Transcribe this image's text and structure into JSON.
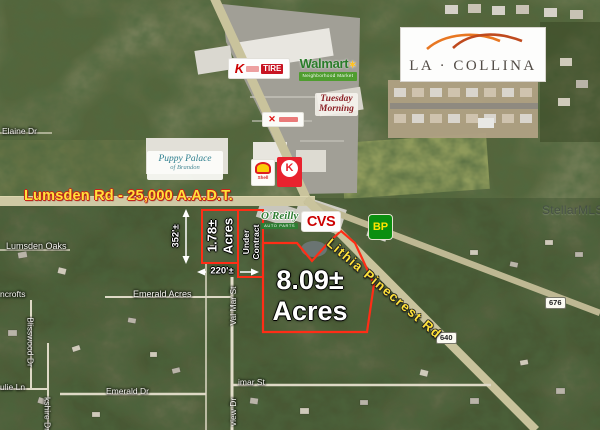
{
  "listing_map": {
    "watermark": "StellarMLS",
    "brand": {
      "la_collina": "LA · COLLINA"
    },
    "roads": {
      "lumsden_label": "Lumsden Rd - 25,000 A.A.D.T.",
      "lithia_label": "Lithia Pinecrest Rd",
      "shield_676": "676",
      "shield_640": "640"
    },
    "streets": {
      "elaine": "Elaine Dr",
      "lumsden_oaks": "Lumsden Oaks",
      "ncrofts": "ncrofts",
      "blisswood": "Blisswood Dr",
      "julie": "ulie Ln",
      "berkshire": "kshire Dr",
      "emerald_acres": "Emerald Acres",
      "emerald_dr": "Emerald Dr",
      "valmar": "Val Mar St",
      "imar": "imar St",
      "view": "view Dr"
    },
    "parcels": {
      "small": {
        "size_line1": "1.78±",
        "size_line2": "Acres",
        "status_line1": "Under",
        "status_line2": "Contract",
        "depth": "352'±",
        "frontage": "220'±"
      },
      "large": {
        "size_line1": "8.09±",
        "size_line2": "Acres"
      }
    },
    "businesses": {
      "walmart": "Walmart",
      "walmart_banner": "Neighborhood Market",
      "tuesday_line1": "Tuesday",
      "tuesday_line2": "Morning",
      "tire_k": "K",
      "tire": "TIRE",
      "puppy_line1": "Puppy Palace",
      "puppy_line2": "of Brandon",
      "shell": "Shell",
      "circle_k": "K",
      "oreilly": "O'Reilly",
      "oreilly_sub": "AUTO PARTS",
      "cvs": "CVS",
      "bp": "BP",
      "x_mark": "✕"
    },
    "colors": {
      "parcel_outline": "#ff2d16",
      "road_label_yellow": "#ffe23a",
      "walmart_green": "#2a7c2a",
      "spark_yellow": "#ffc220",
      "cvs_red": "#cc0000",
      "circle_k_red": "#e8222e",
      "bp_green": "#0b8f10",
      "bp_yellow": "#ffe400",
      "oreilly_green": "#2f7d33",
      "tuesday_maroon": "#8b2025",
      "puppy_teal": "#2e7f8f",
      "swoosh_orange": "#e87722",
      "swoosh_rust": "#bf4a1e"
    }
  }
}
